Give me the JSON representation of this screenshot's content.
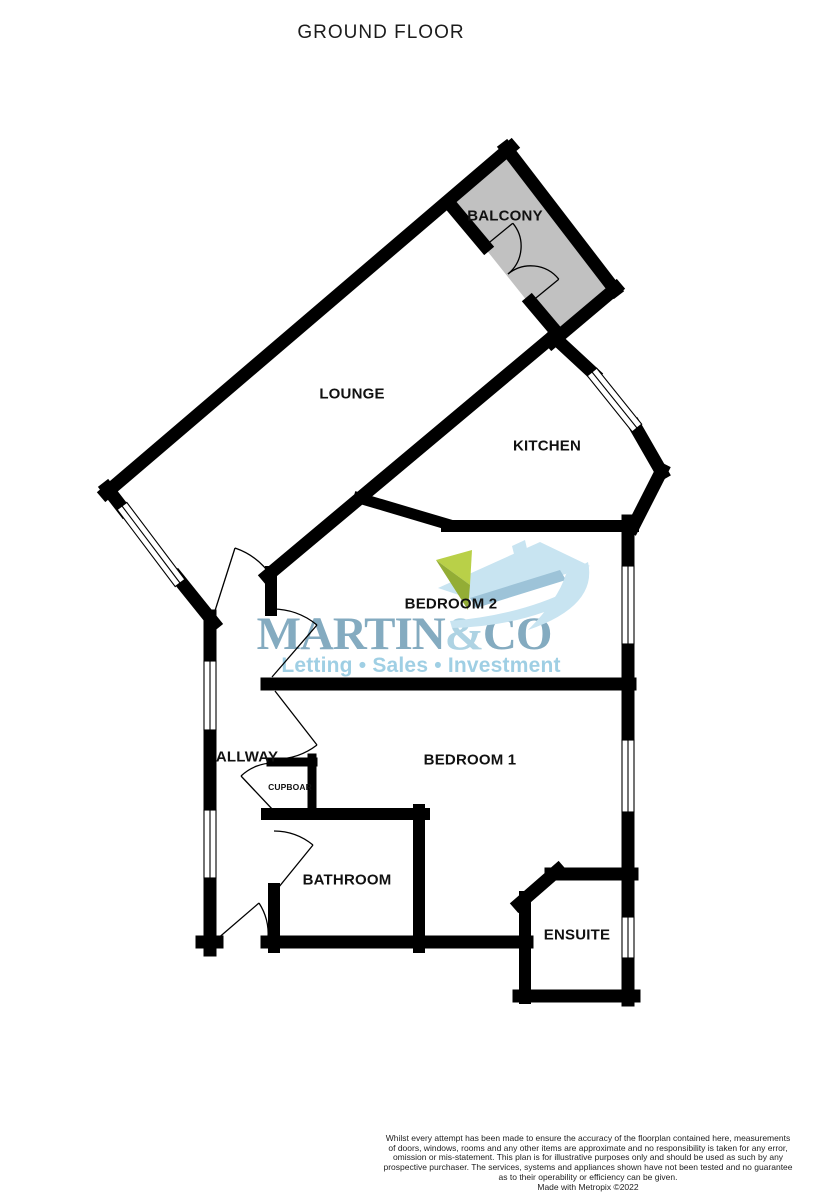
{
  "title": "GROUND FLOOR",
  "rooms": {
    "balcony": "BALCONY",
    "lounge": "LOUNGE",
    "kitchen": "KITCHEN",
    "bedroom2": "BEDROOM 2",
    "bedroom1": "BEDROOM 1",
    "hallway": "ALLWAY",
    "cupboard": "CUPBOAR",
    "bathroom": "BATHROOM",
    "ensuite": "ENSUITE"
  },
  "logo": {
    "martin": "MARTIN",
    "ampersand": "&",
    "co": "CO",
    "tagline": "Letting • Sales • Investment"
  },
  "footer": {
    "disclaimer_lines": [
      "Whilst every attempt has been made to ensure the accuracy of the floorplan contained here, measurements",
      "of doors, windows, rooms and any other items are approximate and no responsibility is taken for any error,",
      "omission or mis-statement. This plan is for illustrative purposes only and should be used as such by any",
      "prospective purchaser. The services, systems and appliances shown have not been tested and no guarantee",
      "as to their operability or efficiency can be given."
    ],
    "credit": "Made with Metropix ©2022"
  },
  "colors": {
    "wall": "#000000",
    "balcony_fill": "#c1c1c1",
    "logo_primary": "#84abc0",
    "logo_light": "#aed3e3",
    "logo_tagline": "#9fcfe4",
    "icon_pale": "#c8e4f1",
    "icon_mid": "#9dc3d8",
    "icon_green": "#b9d048",
    "icon_green_dark": "#93ad35"
  }
}
